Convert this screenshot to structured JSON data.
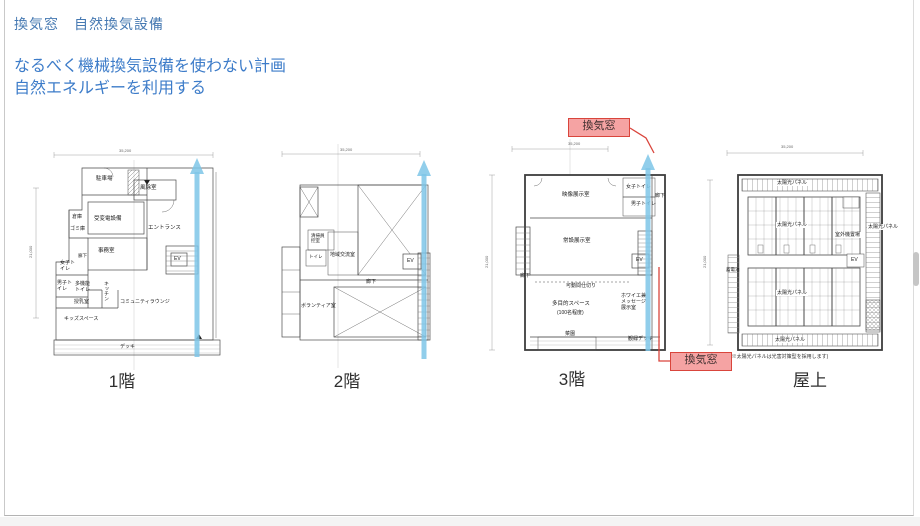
{
  "slide": {
    "title": "換気窓　自然換気設備",
    "subtitle1": "なるべく機械換気設備を使わない計画",
    "subtitle2": "自然エネルギーを利用する"
  },
  "colors": {
    "accent_blue": "#3D7CC9",
    "callout_red": "#D9453C",
    "callout_fill": "#F5A3A3",
    "arrow_blue": "#7EC5E8"
  },
  "callouts": {
    "top": "換気窓",
    "bottom": "換気窓"
  },
  "plans": [
    {
      "caption": "1階",
      "dim_top": "35,200",
      "dim_left": "21,000",
      "rooms": [
        "駐車場",
        "風除室",
        "倉庫",
        "ゴミ庫",
        "受変電設備",
        "エントランス",
        "事務室",
        "廊下",
        "女子トイレ",
        "男子トイレ",
        "多機能トイレ",
        "授乳室",
        "キッチン",
        "コミュニティラウンジ",
        "キッズスペース",
        "デッキ",
        "EV"
      ]
    },
    {
      "caption": "2階",
      "dim_top": "35,200",
      "rooms": [
        "清掃員控室",
        "トイレ",
        "地域交流室",
        "廊下",
        "ボランティア室",
        "EV"
      ]
    },
    {
      "caption": "3階",
      "dim_top": "35,200",
      "dim_left": "21,000",
      "rooms": [
        "映像展示室",
        "女子トイレ",
        "男子トイレ",
        "廊下",
        "常設展示室",
        "EV",
        "廊下",
        "可動間仕切り",
        "多目的スペース",
        "(100名程度)",
        "ホワイエ兼メッセージ展示室",
        "菜園",
        "観緑デッキ"
      ]
    },
    {
      "caption": "屋上",
      "dim_top": "35,200",
      "dim_left": "21,000",
      "rooms": [
        "太陽光パネル",
        "太陽光パネル",
        "室外機置場",
        "太陽光パネル",
        "EV",
        "蓄電池",
        "太陽光パネル",
        "太陽光パネル"
      ],
      "note": "(※太陽光パネルは光害対策型を採用します)"
    }
  ]
}
